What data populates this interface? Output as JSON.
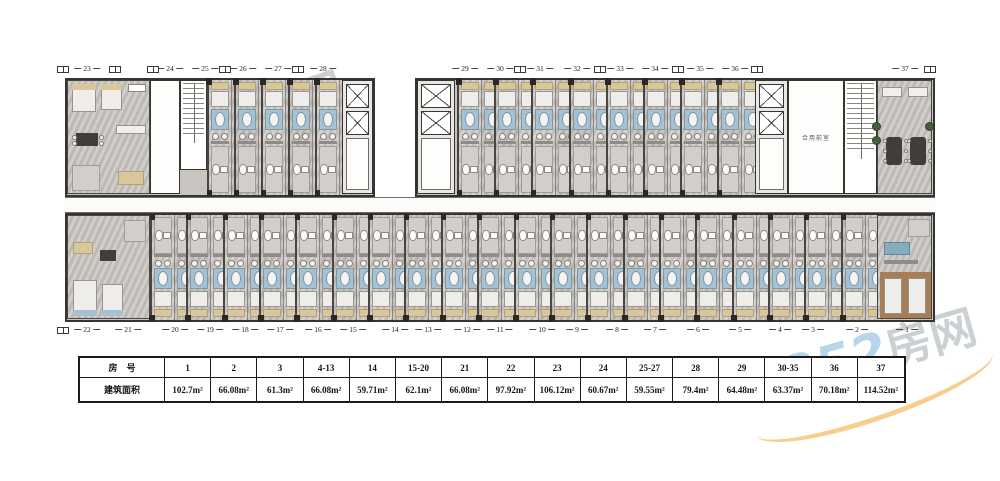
{
  "watermark": {
    "brand_number": "0352",
    "brand_name": "房网"
  },
  "plan": {
    "shared_lobby_label": "合用前室",
    "top_units": [
      "23",
      "24",
      "25",
      "26",
      "27",
      "28",
      "29",
      "30",
      "31",
      "32",
      "33",
      "34",
      "35",
      "36",
      "37"
    ],
    "bottom_units": [
      "22",
      "21",
      "20",
      "19",
      "18",
      "17",
      "16",
      "15",
      "14",
      "13",
      "12",
      "11",
      "10",
      "9",
      "8",
      "7",
      "6",
      "5",
      "4",
      "3",
      "2",
      "1"
    ]
  },
  "table": {
    "row1_header": "房　号",
    "row2_header": "建筑面积",
    "columns": [
      {
        "room": "1",
        "area": "102.7m²"
      },
      {
        "room": "2",
        "area": "66.08m²"
      },
      {
        "room": "3",
        "area": "61.3m²"
      },
      {
        "room": "4-13",
        "area": "66.08m²"
      },
      {
        "room": "14",
        "area": "59.71m²"
      },
      {
        "room": "15-20",
        "area": "62.1m²"
      },
      {
        "room": "21",
        "area": "66.08m²"
      },
      {
        "room": "22",
        "area": "97.92m²"
      },
      {
        "room": "23",
        "area": "106.12m²"
      },
      {
        "room": "24",
        "area": "60.67m²"
      },
      {
        "room": "25-27",
        "area": "59.55m²"
      },
      {
        "room": "28",
        "area": "79.4m²"
      },
      {
        "room": "29",
        "area": "64.48m²"
      },
      {
        "room": "30-35",
        "area": "63.37m²"
      },
      {
        "room": "36",
        "area": "70.18m²"
      },
      {
        "room": "37",
        "area": "114.52m²"
      }
    ]
  }
}
